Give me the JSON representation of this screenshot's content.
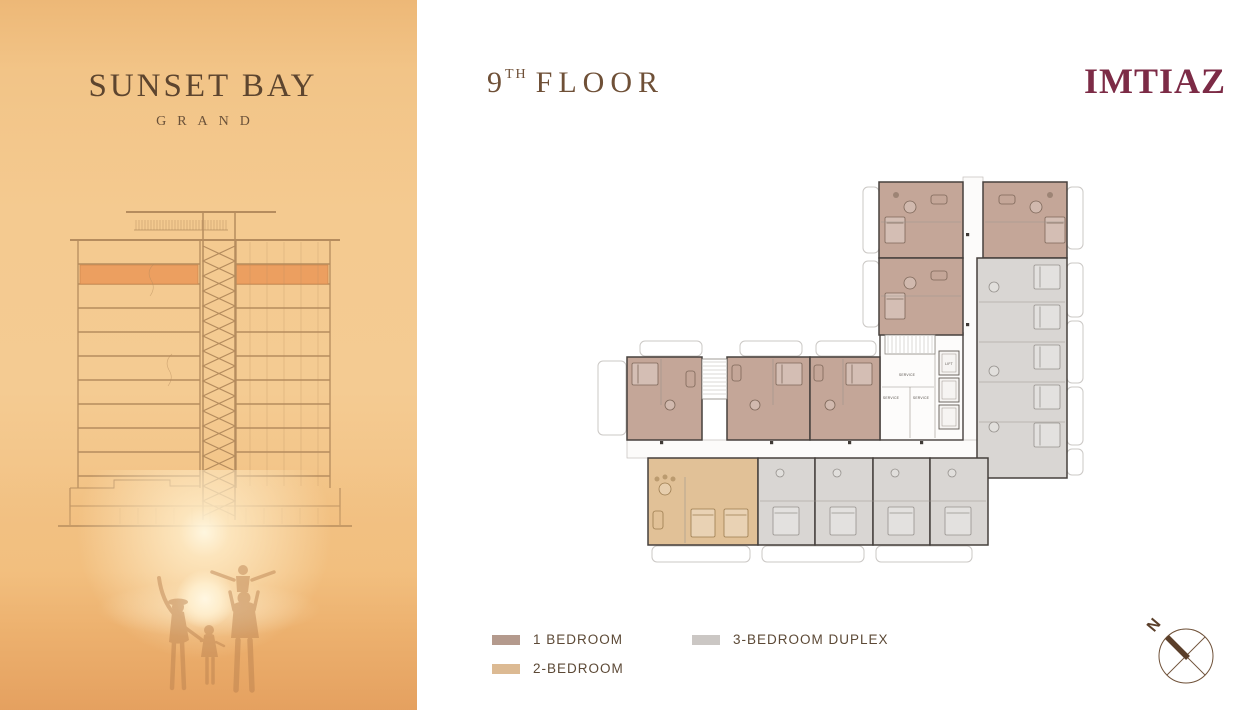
{
  "brand": {
    "name": "SUNSET BAY",
    "subname": "GRAND",
    "developer": "IMTIAZ"
  },
  "header": {
    "floor_number": "9",
    "floor_suffix": "TH",
    "floor_word": "FLOOR"
  },
  "legend": {
    "items": [
      {
        "label": "1 BEDROOM",
        "color": "#b49a8d"
      },
      {
        "label": "2-BEDROOM",
        "color": "#dcba93"
      },
      {
        "label": "3-BEDROOM DUPLEX",
        "color": "#cbc7c4"
      }
    ]
  },
  "compass": {
    "north_label": "N"
  },
  "colors": {
    "title_brown": "#6f5037",
    "developer_maroon": "#7c2b46",
    "highlight_floor": "#ec9f60"
  },
  "floor_plan": {
    "unit_fills": {
      "brown": "#c4a698",
      "tan": "#e1c197",
      "gray": "#d9d6d3"
    },
    "balconies": [
      [
        273,
        12,
        16,
        66
      ],
      [
        273,
        86,
        16,
        66
      ],
      [
        477,
        12,
        16,
        62
      ],
      [
        477,
        88,
        16,
        54
      ],
      [
        477,
        146,
        16,
        62
      ],
      [
        477,
        212,
        16,
        58
      ],
      [
        477,
        274,
        16,
        26
      ],
      [
        50,
        166,
        62,
        15
      ],
      [
        150,
        166,
        62,
        15
      ],
      [
        226,
        166,
        60,
        15
      ],
      [
        8,
        186,
        28,
        74
      ],
      [
        62,
        371,
        98,
        16
      ],
      [
        172,
        371,
        102,
        16
      ],
      [
        286,
        371,
        96,
        16
      ]
    ],
    "corridors": [
      [
        373,
        2,
        20,
        281
      ],
      [
        37,
        265,
        356,
        18
      ]
    ],
    "core": {
      "x": 290,
      "y": 158,
      "w": 83,
      "h": 107
    },
    "units": [
      {
        "x": 289,
        "y": 7,
        "w": 84,
        "h": 76,
        "type": "brown",
        "furn": [
          [
            "t",
            320,
            32,
            6
          ],
          [
            "b",
            295,
            42,
            20,
            26
          ],
          [
            "s",
            341,
            20,
            16,
            9
          ],
          [
            "c",
            306,
            20,
            3
          ]
        ]
      },
      {
        "x": 289,
        "y": 83,
        "w": 84,
        "h": 77,
        "type": "brown",
        "furn": [
          [
            "t",
            320,
            108,
            6
          ],
          [
            "b",
            295,
            118,
            20,
            26
          ],
          [
            "s",
            341,
            96,
            16,
            9
          ]
        ]
      },
      {
        "x": 393,
        "y": 7,
        "w": 84,
        "h": 76,
        "type": "brown",
        "furn": [
          [
            "t",
            446,
            32,
            6
          ],
          [
            "b",
            455,
            42,
            20,
            26
          ],
          [
            "s",
            409,
            20,
            16,
            9
          ],
          [
            "c",
            460,
            20,
            3
          ]
        ]
      },
      {
        "x": 387,
        "y": 83,
        "w": 90,
        "h": 220,
        "type": "gray",
        "furn": [
          [
            "b",
            444,
            90,
            26,
            24
          ],
          [
            "b",
            444,
            130,
            26,
            24
          ],
          [
            "b",
            444,
            170,
            26,
            24
          ],
          [
            "b",
            444,
            210,
            26,
            24
          ],
          [
            "b",
            444,
            248,
            26,
            24
          ],
          [
            "t",
            404,
            112,
            5
          ],
          [
            "t",
            404,
            196,
            5
          ],
          [
            "t",
            404,
            252,
            5
          ]
        ]
      },
      {
        "x": 37,
        "y": 182,
        "w": 75,
        "h": 83,
        "type": "brown",
        "furn": [
          [
            "b",
            42,
            188,
            26,
            22
          ],
          [
            "t",
            80,
            230,
            5
          ],
          [
            "s",
            96,
            196,
            9,
            16
          ]
        ]
      },
      {
        "x": 137,
        "y": 182,
        "w": 83,
        "h": 83,
        "type": "brown",
        "furn": [
          [
            "s",
            142,
            190,
            9,
            16
          ],
          [
            "b",
            186,
            188,
            26,
            22
          ],
          [
            "t",
            165,
            230,
            5
          ]
        ]
      },
      {
        "x": 220,
        "y": 182,
        "w": 70,
        "h": 83,
        "type": "brown",
        "furn": [
          [
            "s",
            224,
            190,
            9,
            16
          ],
          [
            "b",
            256,
            188,
            26,
            22
          ],
          [
            "t",
            240,
            230,
            5
          ]
        ]
      },
      {
        "x": 58,
        "y": 283,
        "w": 110,
        "h": 87,
        "type": "tan",
        "furn": [
          [
            "t",
            75,
            314,
            6
          ],
          [
            "c",
            67,
            304,
            2.5
          ],
          [
            "c",
            75,
            302,
            2.5
          ],
          [
            "c",
            83,
            304,
            2.5
          ],
          [
            "s",
            63,
            336,
            10,
            18
          ],
          [
            "b",
            101,
            334,
            24,
            28
          ],
          [
            "b",
            134,
            334,
            24,
            28
          ]
        ]
      },
      {
        "x": 168,
        "y": 283,
        "w": 57,
        "h": 87,
        "type": "gray",
        "furn": [
          [
            "t",
            190,
            298,
            4
          ],
          [
            "b",
            183,
            332,
            26,
            28
          ]
        ]
      },
      {
        "x": 225,
        "y": 283,
        "w": 58,
        "h": 87,
        "type": "gray",
        "furn": [
          [
            "t",
            247,
            298,
            4
          ],
          [
            "b",
            240,
            332,
            26,
            28
          ]
        ]
      },
      {
        "x": 283,
        "y": 283,
        "w": 57,
        "h": 87,
        "type": "gray",
        "furn": [
          [
            "t",
            305,
            298,
            4
          ],
          [
            "b",
            298,
            332,
            26,
            28
          ]
        ]
      },
      {
        "x": 340,
        "y": 283,
        "w": 58,
        "h": 87,
        "type": "gray",
        "furn": [
          [
            "t",
            362,
            298,
            4
          ],
          [
            "b",
            355,
            332,
            26,
            28
          ]
        ]
      }
    ],
    "walls": [
      [
        389,
        127,
        475,
        127
      ],
      [
        389,
        167,
        475,
        167
      ],
      [
        389,
        207,
        475,
        207
      ],
      [
        389,
        247,
        475,
        247
      ],
      [
        291,
        47,
        371,
        47
      ],
      [
        291,
        121,
        371,
        121
      ],
      [
        395,
        47,
        475,
        47
      ],
      [
        71,
        184,
        71,
        230
      ],
      [
        183,
        184,
        183,
        230
      ],
      [
        253,
        184,
        253,
        230
      ],
      [
        95,
        302,
        95,
        368
      ],
      [
        170,
        326,
        396,
        326
      ],
      [
        345,
        160,
        345,
        263
      ],
      [
        292,
        212,
        344,
        212
      ],
      [
        320,
        212,
        320,
        263
      ]
    ],
    "stairs": [
      {
        "x": 112,
        "y": 184,
        "w": 25,
        "h": 40,
        "dir": "h"
      },
      {
        "x": 295,
        "y": 160,
        "w": 50,
        "h": 19,
        "dir": "v"
      }
    ],
    "lifts": [
      [
        349,
        176,
        20,
        24
      ],
      [
        349,
        203,
        20,
        24
      ],
      [
        349,
        230,
        20,
        24
      ]
    ],
    "chips": [
      [
        70,
        266
      ],
      [
        180,
        266
      ],
      [
        258,
        266
      ],
      [
        330,
        266
      ],
      [
        376,
        58
      ],
      [
        376,
        148
      ]
    ],
    "labels": [
      {
        "t": "SERVICE",
        "x": 317,
        "y": 201
      },
      {
        "t": "SERVICE",
        "x": 301,
        "y": 224
      },
      {
        "t": "SERVICE",
        "x": 331,
        "y": 224
      },
      {
        "t": "LIFT",
        "x": 359,
        "y": 190
      }
    ]
  }
}
